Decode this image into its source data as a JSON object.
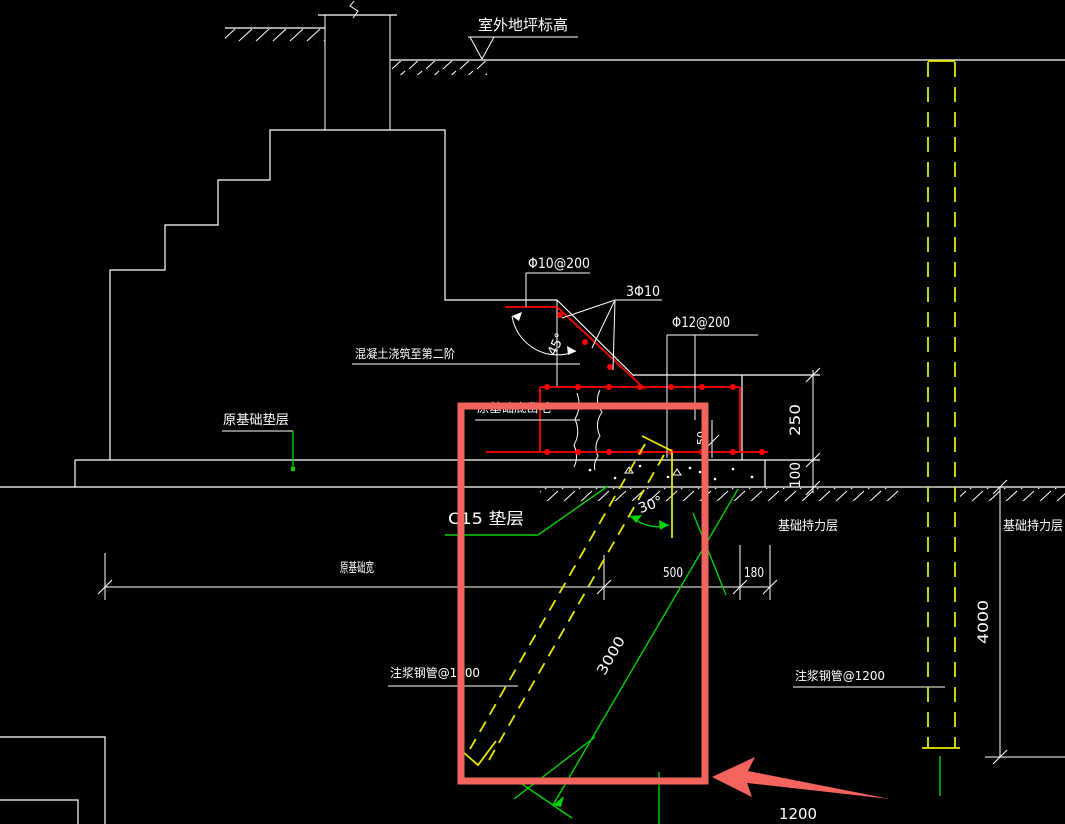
{
  "drawing": {
    "ground": {
      "level_label": "室外地坪标高"
    },
    "rebar": {
      "stirrup": "Φ10@200",
      "slope_bars": "3Φ10",
      "main_bars": "Φ12@200",
      "slope_angle": "45°"
    },
    "notes": {
      "pour": "混凝土浇筑至第二阶",
      "orig_cushion": "原基础垫层",
      "chisel": "原基础底凿毛",
      "cushion": "C15  垫层",
      "bearing_left": "基础持力层",
      "bearing_right": "基础持力层",
      "grout_left": "注浆钢管@1200",
      "grout_right": "注浆钢管@1200",
      "pipe_angle": "30°"
    },
    "dims": {
      "w_orig": "原基础宽",
      "d500": "500",
      "d180": "180",
      "d250": "250",
      "d100": "100",
      "d50": "50",
      "pipe_len": "3000",
      "depth": "4000",
      "spacing": "1200"
    },
    "colors": {
      "background": "#000000",
      "outline": "#ffffff",
      "rebar": "#ff0000",
      "highlight": "#f4645f",
      "dimension_green": "#00d200",
      "pipe_yellow": "#e8e800"
    }
  }
}
